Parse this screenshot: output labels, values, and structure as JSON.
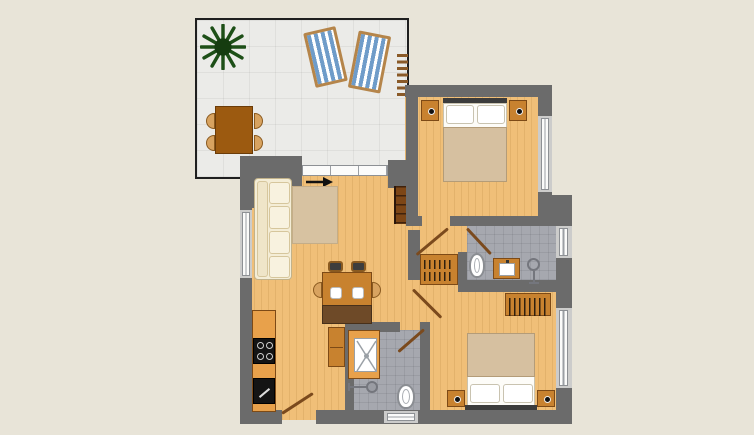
{
  "meta": {
    "kind": "apartment floor plan with roof terrace",
    "text_labels": []
  },
  "palette": {
    "bg": "#e8e4d8",
    "floor": "#f0bf78",
    "wall": "#6b6b6b",
    "terrace": "#ebebe8",
    "bath": "#a6a8af",
    "wood": "#c8822f",
    "darkwood": "#6e4a28",
    "door": "#7b4a1d",
    "cream": "#f4edd6",
    "rug": "#d7c2a1",
    "blanket": "#d6c0a0",
    "blue": "#6f9cc9",
    "frame": "#b5854a",
    "counter": "#e8a14b",
    "appliance": "#141414",
    "fixture": "#74767d",
    "winw": "#fbfbfa",
    "otable": "#9c5a10",
    "green": "#1d4f17"
  },
  "rooms": [
    {
      "id": "terrace",
      "floor": "light-gray tiles",
      "items": [
        "potted plant",
        "deck chair",
        "deck chair",
        "ladder",
        "outdoor table",
        "4 outdoor chairs"
      ]
    },
    {
      "id": "living-room",
      "floor": "wood",
      "items": [
        "corner sofa",
        "rug",
        "wall shelf",
        "dining table",
        "2 chairs",
        "2 side chairs",
        "2 plates",
        "sideboard bench",
        "cabinet",
        "entry arrow"
      ]
    },
    {
      "id": "kitchen",
      "floor": "wood",
      "items": [
        "counter",
        "cooktop with 4 burners",
        "sink"
      ]
    },
    {
      "id": "bedroom-top",
      "floor": "wood",
      "items": [
        "double bed",
        "2 pillows",
        "2 nightstands with lamps",
        "window"
      ]
    },
    {
      "id": "bedroom-bottom",
      "floor": "wood",
      "items": [
        "double bed",
        "2 pillows",
        "2 nightstands with lamps",
        "wardrobe with hangers",
        "window"
      ]
    },
    {
      "id": "bathroom",
      "floor": "gray tiles",
      "items": [
        "toilet",
        "vanity sink",
        "shower fixture",
        "window"
      ]
    },
    {
      "id": "shower-room",
      "floor": "gray tiles",
      "items": [
        "shower tray",
        "shower fixture",
        "toilet",
        "window"
      ]
    },
    {
      "id": "hallway",
      "floor": "wood",
      "items": [
        "wardrobe with hangers"
      ]
    }
  ],
  "openings": {
    "interior_doors": 4,
    "exterior_doors": 2,
    "windows": 5,
    "glass_terrace_door": 1
  }
}
